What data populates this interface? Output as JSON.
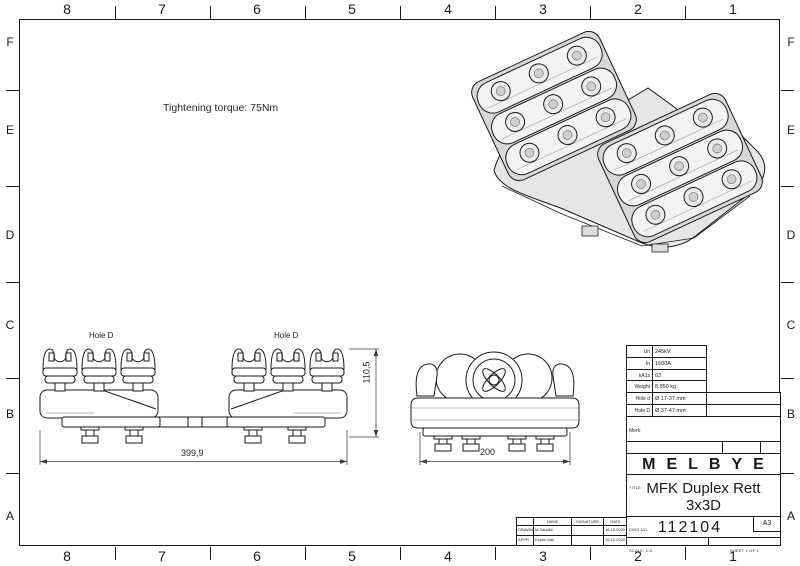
{
  "sheet": {
    "annotation": "Tightening torque: 75Nm",
    "border": {
      "columns": [
        "8",
        "7",
        "6",
        "5",
        "4",
        "3",
        "2",
        "1"
      ],
      "rows": [
        "F",
        "E",
        "D",
        "C",
        "B",
        "A"
      ]
    }
  },
  "views": {
    "front": {
      "hole_label_left": "Hole D",
      "hole_label_right": "Hole D",
      "dim_width": "399,9",
      "dim_height": "110,5"
    },
    "side": {
      "dim_width": "200"
    }
  },
  "title_block": {
    "specs": {
      "rows": [
        {
          "label": "Un",
          "value": "245kV"
        },
        {
          "label": "In",
          "value": "1600A"
        },
        {
          "label": "kA1s",
          "value": "63"
        },
        {
          "label": "Weight",
          "value": "8.850 kg"
        },
        {
          "label": "Hole d",
          "value": "Ø 17-37 mm"
        },
        {
          "label": "Hole D",
          "value": "Ø 37-47 mm"
        }
      ]
    },
    "merk_label": "Merk:",
    "do_not_scale": "DO NOT SCALE DRAWING",
    "revision_label": "REVISION",
    "revision_value": "1",
    "brand": "MELBYE",
    "title_label": "TITLE:",
    "title_line1": "MFK Duplex Rett",
    "title_line2": "3x3D",
    "dwg_label": "DWG NO.",
    "dwg_number": "112104",
    "paper_size": "A3",
    "scale_text": "SCALE: 1:5",
    "sheet_text": "SHEET 1 OF 1",
    "approvals": {
      "headers": [
        "NAME",
        "SIGNATURE",
        "DATE"
      ],
      "rows": [
        {
          "role": "DRAWN",
          "name": "M.Sandlie",
          "date": "16.12.2020"
        },
        {
          "role": "APPR",
          "name": "Espen Aas",
          "date": "16.12.2020"
        }
      ]
    }
  },
  "colors": {
    "paper": "#ffffff",
    "line": "#1a1a1a",
    "dim_line": "#3c3c3c",
    "shade_light": "#f1f1f1",
    "shade_mid": "#d8d8d8",
    "shade_dark": "#c9c9c9"
  }
}
